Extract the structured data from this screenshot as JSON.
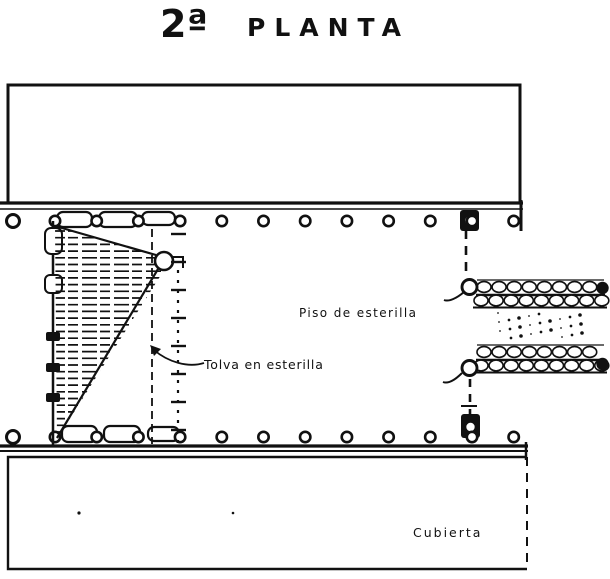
{
  "title": {
    "prefix": "2ª",
    "text": "PLANTA"
  },
  "labels": {
    "floor": "Piso de esterilla",
    "hopper": "Tolva en esterilla",
    "roof": "Cubierta"
  },
  "colors": {
    "ink": "#111111",
    "paper": "#ffffff"
  },
  "structure": {
    "top_post_count": 13,
    "bottom_post_count": 13,
    "walkway_count": 2,
    "walkway_segments_per_row": 8,
    "left_tie_count": 5
  }
}
